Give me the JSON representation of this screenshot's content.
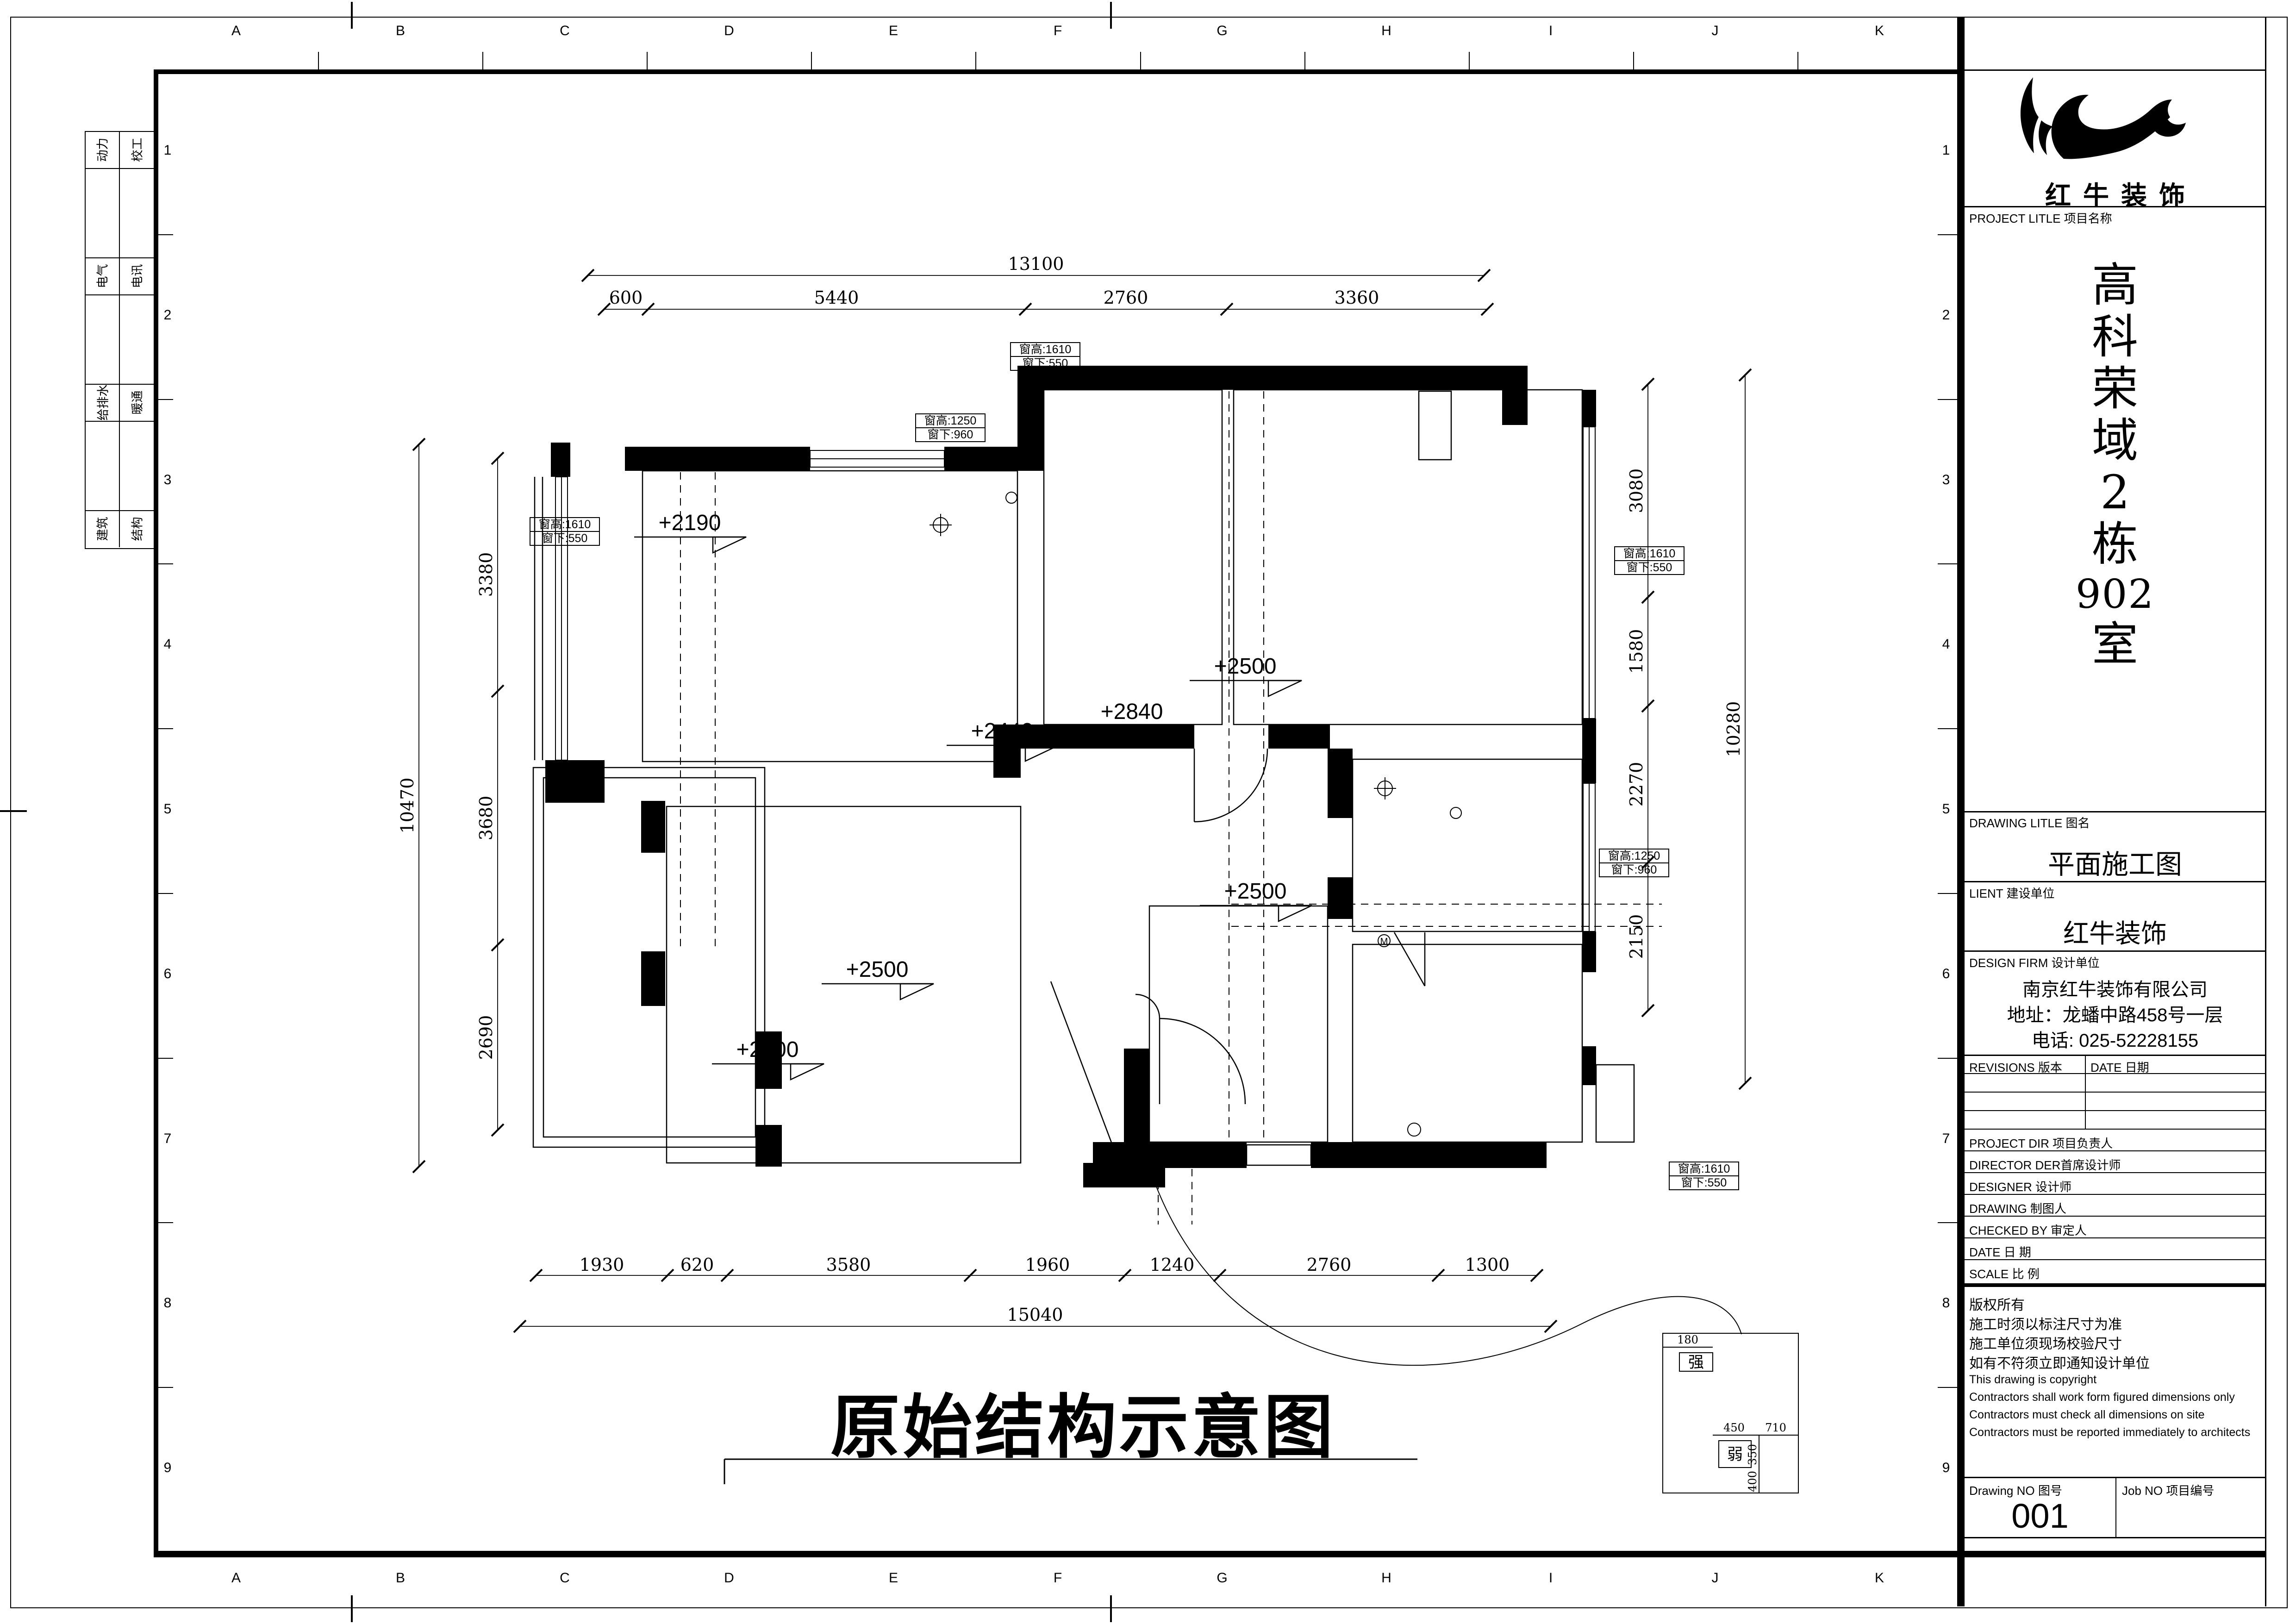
{
  "sheet": {
    "grid_letters": [
      "A",
      "B",
      "C",
      "D",
      "E",
      "F",
      "G",
      "H",
      "I",
      "J",
      "K"
    ],
    "grid_numbers": [
      "1",
      "2",
      "3",
      "4",
      "5",
      "6",
      "7",
      "8",
      "9"
    ],
    "drawing_title": "原始结构示意图"
  },
  "signature_strip": {
    "rows": [
      {
        "left": "动力",
        "right": "校工"
      },
      {
        "left": "电气",
        "right": "电讯"
      },
      {
        "left": "给排水",
        "right": "暖通"
      },
      {
        "left": "建筑",
        "right": "结构"
      }
    ]
  },
  "plan": {
    "dims_top": {
      "overall": "13100",
      "segments": [
        "600",
        "5440",
        "2760",
        "3360"
      ]
    },
    "dims_bottom": {
      "overall": "15040",
      "segments": [
        "1930",
        "620",
        "3580",
        "1960",
        "1240",
        "2760",
        "1300"
      ]
    },
    "dims_left": {
      "overall": "10470",
      "segments": [
        "3380",
        "3680",
        "2690"
      ]
    },
    "dims_right": {
      "overall": "10280",
      "segments": [
        "3080",
        "1580",
        "2270",
        "2150"
      ]
    },
    "levels": [
      "+2190",
      "+2440",
      "+2840",
      "+2500",
      "+2500",
      "+2500",
      "+2500"
    ],
    "window_tags": [
      {
        "line1": "窗高:1610",
        "line2": "窗下:550"
      },
      {
        "line1": "窗高:1250",
        "line2": "窗下:960"
      },
      {
        "line1": "窗高:1610",
        "line2": "窗下:550"
      },
      {
        "line1": "窗高:1610",
        "line2": "窗下:550"
      },
      {
        "line1": "窗高:1250",
        "line2": "窗下:960"
      },
      {
        "line1": "窗高:1610",
        "line2": "窗下:550"
      }
    ],
    "appliance_label": "M",
    "legend": {
      "strong": "强",
      "weak": "弱",
      "dim_180": "180",
      "dim_450": "450",
      "dim_710": "710",
      "dim_350": "350",
      "dim_400": "400"
    }
  },
  "title_block": {
    "logo_text": "红牛装饰",
    "project_label": "PROJECT LITLE 项目名称",
    "project_name_chars": [
      "高",
      "科",
      "荣",
      "域",
      "2",
      "栋",
      "902",
      "室"
    ],
    "drawing_label": "DRAWING LITLE 图名",
    "drawing_name": "平面施工图",
    "client_label": "LIENT 建设单位",
    "client_name": "红牛装饰",
    "firm_label": "DESIGN FIRM 设计单位",
    "firm_lines": [
      "南京红牛装饰有限公司",
      "地址：龙蟠中路458号一层",
      "电话: 025-52228155"
    ],
    "revisions_label": "REVISIONS 版本",
    "revisions_date_label": "DATE 日期",
    "staff_rows": [
      "PROJECT DIR  项目负责人",
      "DIRECTOR DER首席设计师",
      "DESIGNER  设计师",
      "DRAWING  制图人",
      "CHECKED BY  审定人",
      "DATE  日  期",
      "SCALE  比  例"
    ],
    "copyright_lines": [
      "版权所有",
      "施工时须以标注尺寸为准",
      "施工单位须现场校验尺寸",
      "如有不符须立即通知设计单位",
      "This drawing is copyright",
      "Contractors shall work form figured dimensions only",
      "Contractors must check all dimensions on site",
      "Contractors must be reported immediately to architects"
    ],
    "drawing_no_label": "Drawing NO 图号",
    "drawing_no": "001",
    "job_no_label": "Job NO 项目编号"
  }
}
